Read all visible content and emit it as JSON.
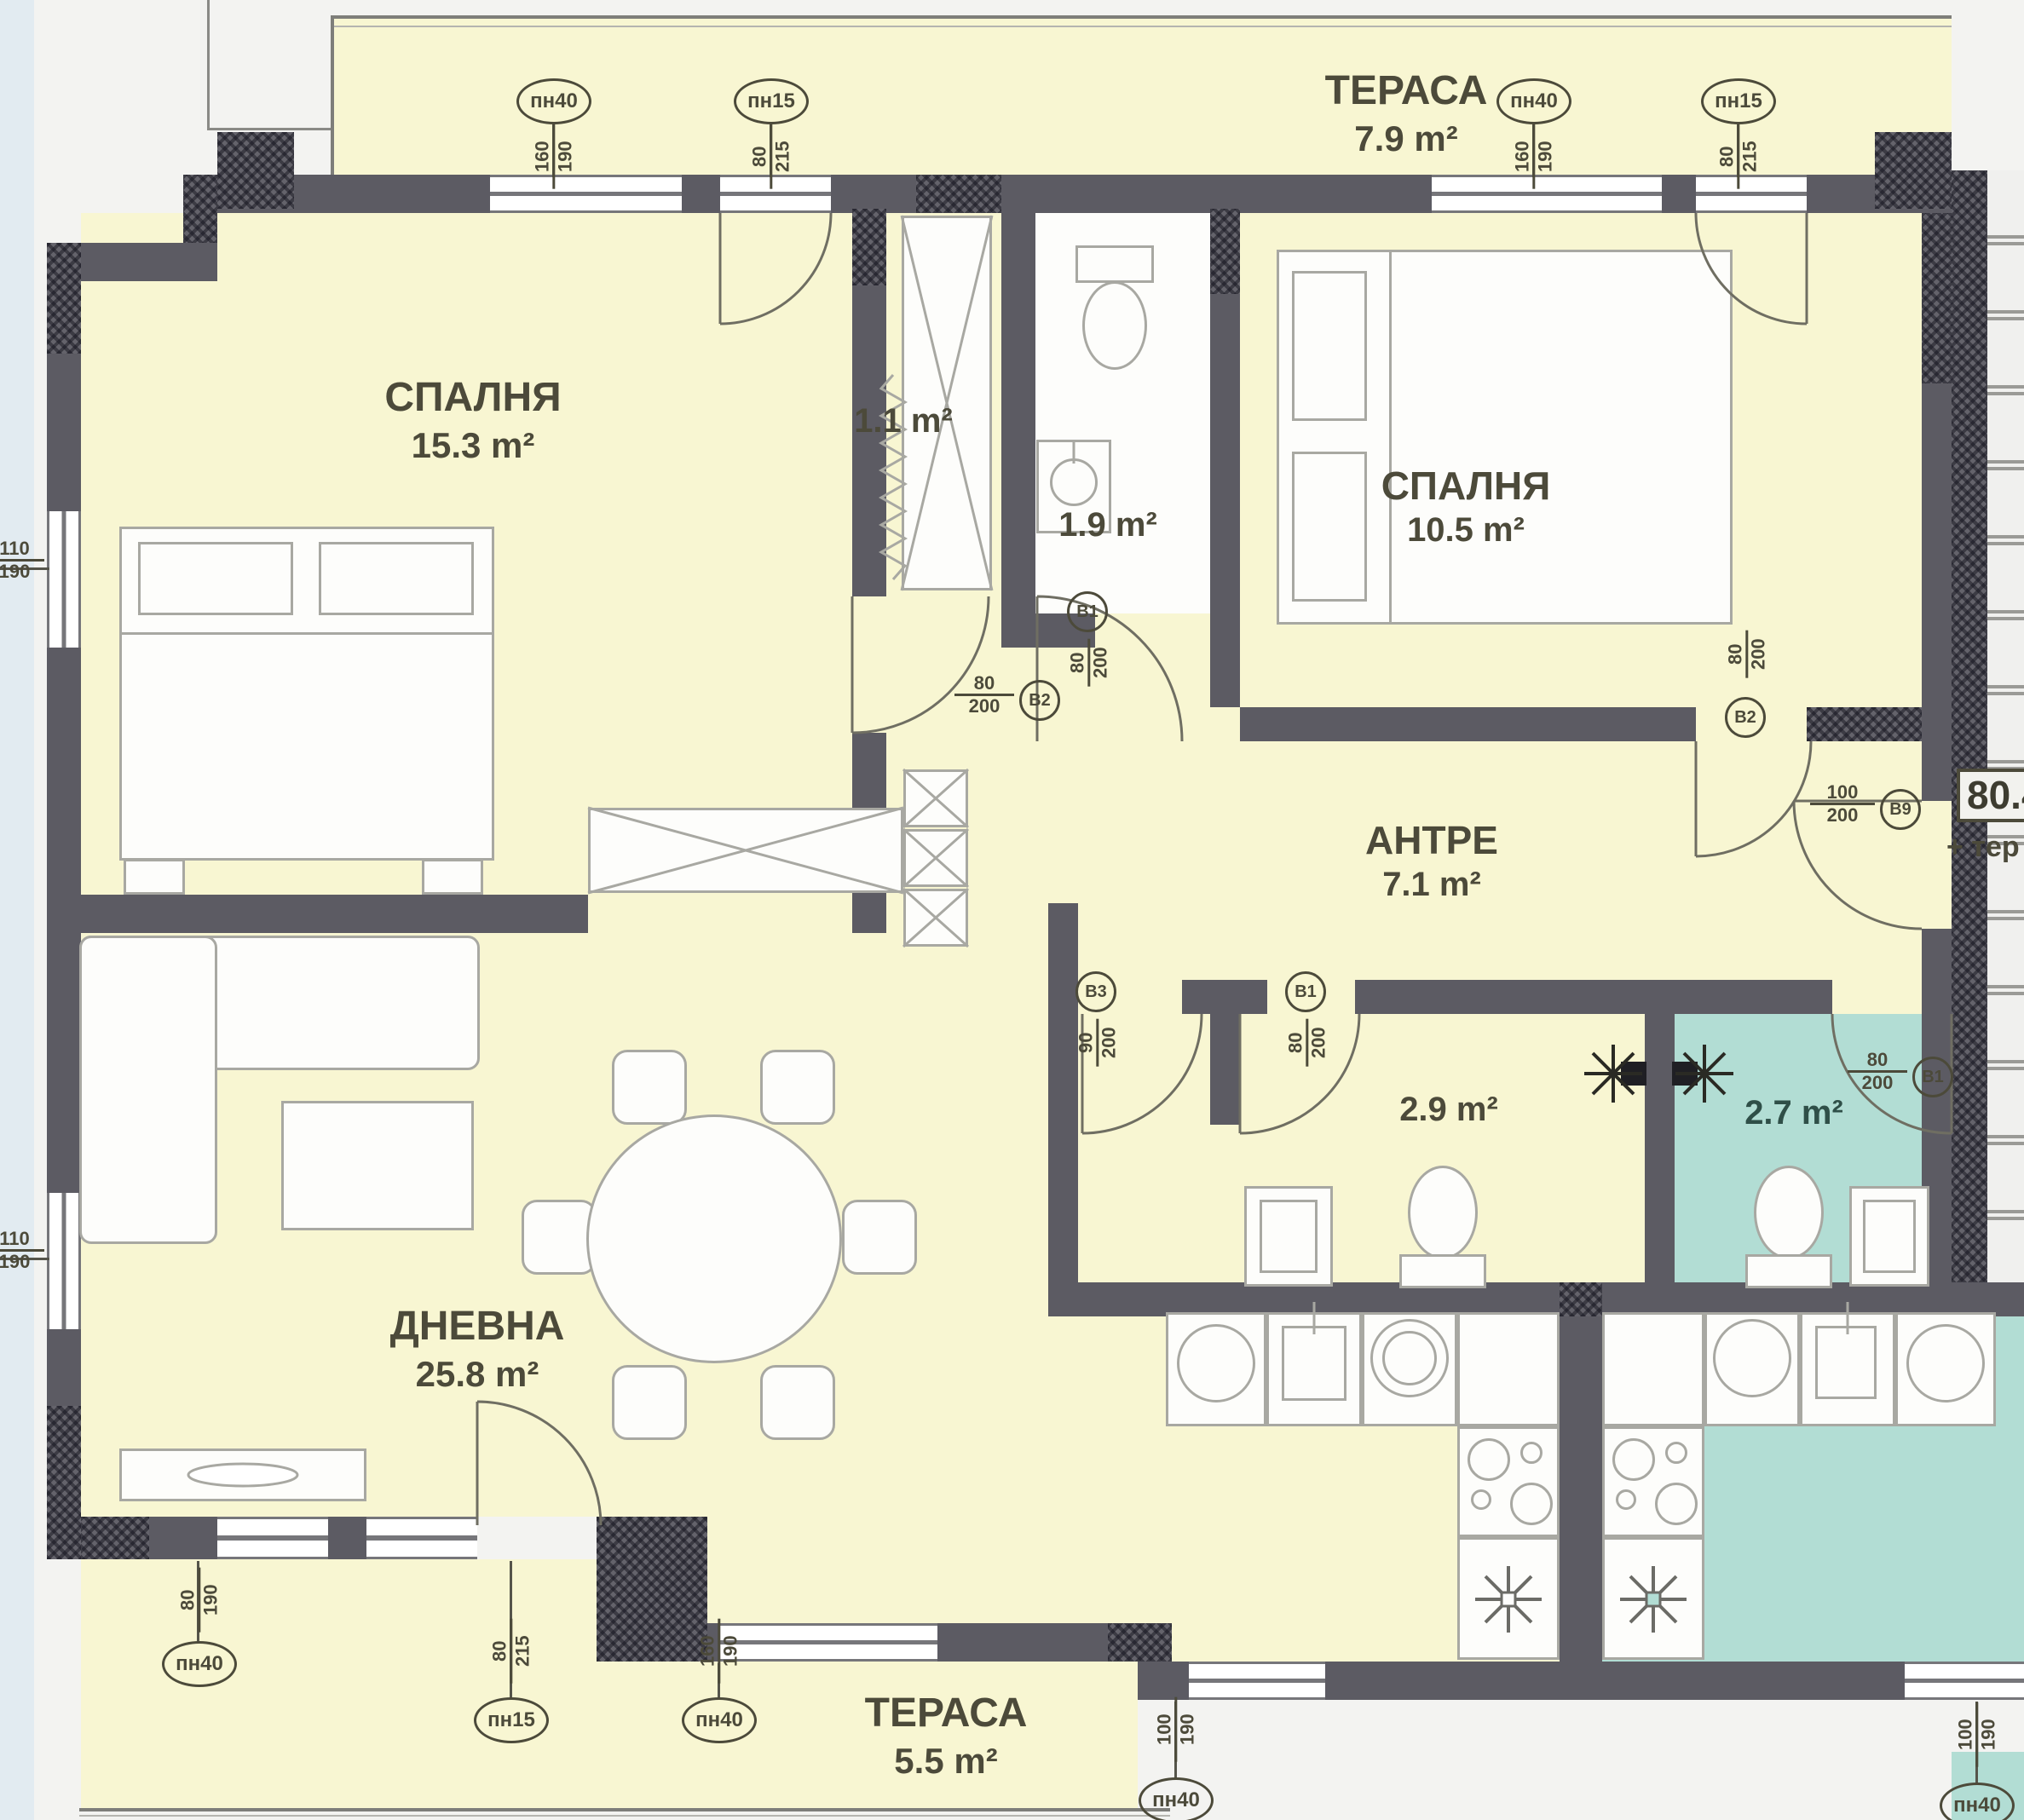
{
  "plan": {
    "rooms": {
      "terrace_top": {
        "name": "ТЕРАСА",
        "area": "7.9 m²"
      },
      "bedroom1": {
        "name": "СПАЛНЯ",
        "area": "15.3 m²"
      },
      "closet": {
        "area": "1.1 m²"
      },
      "wc_small": {
        "area": "1.9 m²"
      },
      "bedroom2": {
        "name": "СПАЛНЯ",
        "area": "10.5 m²"
      },
      "hallway": {
        "name": "АНТРЕ",
        "area": "7.1 m²"
      },
      "living": {
        "name": "ДНЕВНА",
        "area": "25.8 m²"
      },
      "bathroom": {
        "area": "2.9 m²"
      },
      "neighbor_bathroom": {
        "area": "2.7 m²"
      },
      "terrace_bottom": {
        "name": "ТЕРАСА",
        "area": "5.5 m²"
      }
    },
    "total_area": {
      "value": "80.4",
      "suffix": "+ тер"
    },
    "window_tags": [
      {
        "id": "пн40",
        "num": "160",
        "den": "190"
      },
      {
        "id": "пн15",
        "num": "80",
        "den": "215"
      },
      {
        "id": "пн40",
        "num": "160",
        "den": "190"
      },
      {
        "id": "пн15",
        "num": "80",
        "den": "215"
      },
      {
        "id": "пн40",
        "num": "80",
        "den": "190"
      },
      {
        "id": "пн15",
        "num": "80",
        "den": "215"
      },
      {
        "id": "пн40",
        "num": "160",
        "den": "190"
      },
      {
        "id": "пн40",
        "num": "100",
        "den": "190"
      },
      {
        "id": "пн40",
        "num": "100",
        "den": "190"
      }
    ],
    "door_tags": [
      {
        "num": "80",
        "den": "200",
        "code": "В2"
      },
      {
        "num": "80",
        "den": "200",
        "code": "В1"
      },
      {
        "num": "80",
        "den": "200",
        "code": "В2"
      },
      {
        "num": "100",
        "den": "200",
        "code": "В9"
      },
      {
        "num": "90",
        "den": "200",
        "code": "В3"
      },
      {
        "num": "80",
        "den": "200",
        "code": "В1"
      },
      {
        "num": "80",
        "den": "200",
        "code": "В1"
      }
    ],
    "side_dims": [
      {
        "num": "110",
        "den": "190"
      },
      {
        "num": "110",
        "den": "190"
      }
    ],
    "colors": {
      "floor": "#f8f6d2",
      "neighbor": "#b2ddd4",
      "wall": "#5c5b63"
    }
  }
}
